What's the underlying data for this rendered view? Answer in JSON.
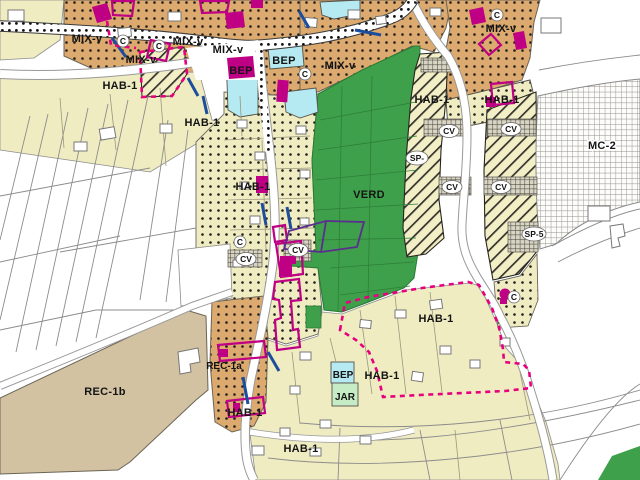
{
  "map": {
    "type": "municipal zoning map (plan de zonage)",
    "labels": {
      "mix_v": "MIX-v",
      "hab_1": "HAB-1",
      "bep": "BEP",
      "jar": "JAR",
      "verd": "VERD",
      "rec_1a": "REC-1a",
      "rec_1b": "REC-1b",
      "mc_2": "MC-2",
      "sp": "SP-",
      "sp_5": "SP-5",
      "cv": "CV",
      "c": "C"
    },
    "colors": {
      "zone_cream": "#F0ECC1",
      "zone_tan": "#DCA96E",
      "zone_rec": "#D2C2A2",
      "zone_green": "#3EA04B",
      "zone_cyan": "#B6EAF2",
      "zone_jar": "#C6ECC5",
      "hatch_bg": "#F2EFC6",
      "building_magenta": "#BF0084",
      "boundary_pink": "#E6007E",
      "overlay_violet": "#5B2D8E",
      "network_blue": "#1D4E9E",
      "label_black": "#141414"
    }
  }
}
